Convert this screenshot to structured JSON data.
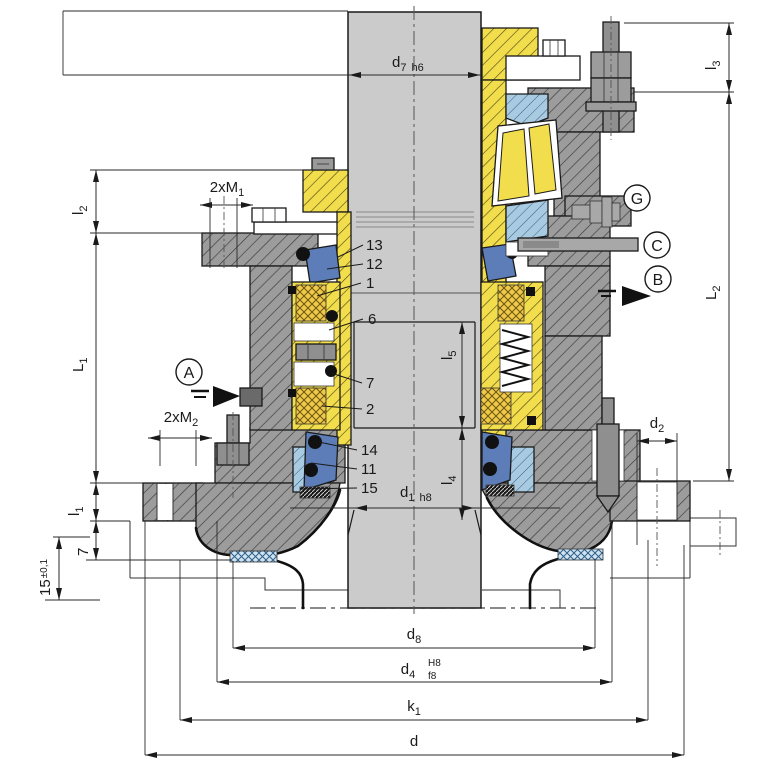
{
  "drawing_type": "mechanical-seal-cross-section",
  "dimensions": {
    "d7": {
      "main": "d",
      "sub": "7",
      "suffix": "h6"
    },
    "l3": {
      "main": "l",
      "sub": "3"
    },
    "l2": {
      "main": "l",
      "sub": "2"
    },
    "L1": {
      "main": "L",
      "sub": "1"
    },
    "L2": {
      "main": "L",
      "sub": "2"
    },
    "m1": {
      "main": "2xM",
      "sub": "1"
    },
    "m2": {
      "main": "2xM",
      "sub": "2"
    },
    "l1": {
      "main": "l",
      "sub": "1"
    },
    "dim7": {
      "main": "7"
    },
    "dim15": {
      "main": "15",
      "suffix": "±0,1"
    },
    "l5": {
      "main": "l",
      "sub": "5"
    },
    "l4": {
      "main": "l",
      "sub": "4"
    },
    "d1": {
      "main": "d",
      "sub": "1",
      "suffix": "h8"
    },
    "d2": {
      "main": "d",
      "sub": "2"
    },
    "d8": {
      "main": "d",
      "sub": "8"
    },
    "d4": {
      "main": "d",
      "sub": "4",
      "tol_upper": "H8",
      "tol_lower": "f8"
    },
    "k1": {
      "main": "k",
      "sub": "1"
    },
    "d": {
      "main": "d"
    }
  },
  "callouts": {
    "n13": "13",
    "n12": "12",
    "n1": "1",
    "n6": "6",
    "n7": "7",
    "n2": "2",
    "n14": "14",
    "n11": "11",
    "n15": "15"
  },
  "markers": {
    "a": "A",
    "b": "B",
    "c": "C",
    "g": "G"
  },
  "colors": {
    "part_yellow": "#f2de4c",
    "face_yellow": "#eec94a",
    "part_gray": "#9c9c9c",
    "steel_gray": "#8f8f8f",
    "shaft_gray": "#cbcbcb",
    "part_blue": "#5c7db8",
    "light_blue": "#a9cbe2",
    "gasket_blue": "#cfe2ee",
    "line_dark": "#1a1a1a"
  }
}
